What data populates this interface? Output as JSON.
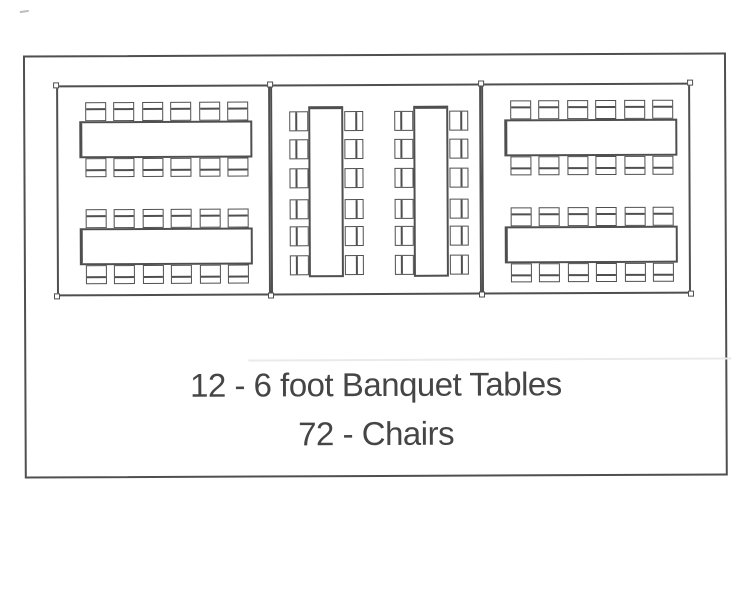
{
  "caption": {
    "line1": "12 - 6 foot Banquet Tables",
    "line2": "72 - Chairs"
  },
  "palette": {
    "line_color": "#4f4f4f",
    "text_color": "#454545",
    "paper_color": "#ffffff"
  },
  "diagram": {
    "type": "banquet-seating-floor-plan",
    "totals": {
      "tables": 12,
      "chairs": 72
    },
    "sections": [
      {
        "id": "left",
        "orientation": "horizontal",
        "table_groups": 2,
        "tables_per_group": 2,
        "chairs": 24
      },
      {
        "id": "center",
        "orientation": "vertical",
        "table_groups": 2,
        "tables_per_group": 2,
        "chairs": 24
      },
      {
        "id": "right",
        "orientation": "horizontal",
        "table_groups": 2,
        "tables_per_group": 2,
        "chairs": 24
      }
    ]
  }
}
